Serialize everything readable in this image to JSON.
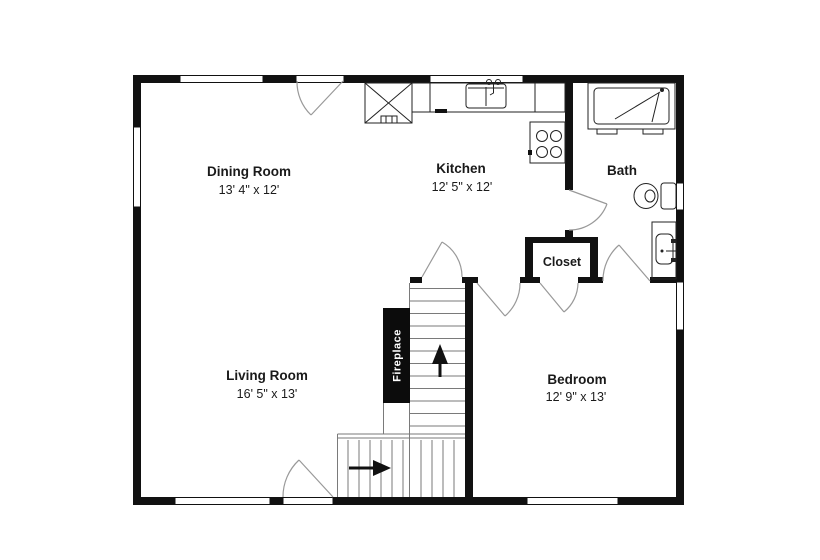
{
  "plan": {
    "rooms": [
      {
        "id": "dining-room",
        "name": "Dining Room",
        "dims": "13' 4\" x 12'"
      },
      {
        "id": "kitchen",
        "name": "Kitchen",
        "dims": "12' 5\" x 12'"
      },
      {
        "id": "bath",
        "name": "Bath",
        "dims": ""
      },
      {
        "id": "closet",
        "name": "Closet",
        "dims": ""
      },
      {
        "id": "living-room",
        "name": "Living Room",
        "dims": "16' 5\" x 13'"
      },
      {
        "id": "bedroom",
        "name": "Bedroom",
        "dims": "12' 9\" x 13'"
      }
    ],
    "fireplace_label": "Fireplace",
    "stairs": {
      "upper_flight_direction": "up",
      "lower_flight_direction": "right"
    },
    "fixture_icons": [
      "refrigerator-icon",
      "kitchen-sink-icon",
      "range-icon",
      "shower-icon",
      "toilet-icon",
      "bathroom-sink-icon",
      "fireplace-icon",
      "stairs-icon"
    ],
    "colors": {
      "wall": "#111111",
      "background": "#ffffff",
      "label_text": "#1a1a1a",
      "fireplace_text": "#ffffff",
      "door_arc": "#999999",
      "stair_line": "#7a7a7a",
      "fixture_stroke": "#222222"
    }
  }
}
